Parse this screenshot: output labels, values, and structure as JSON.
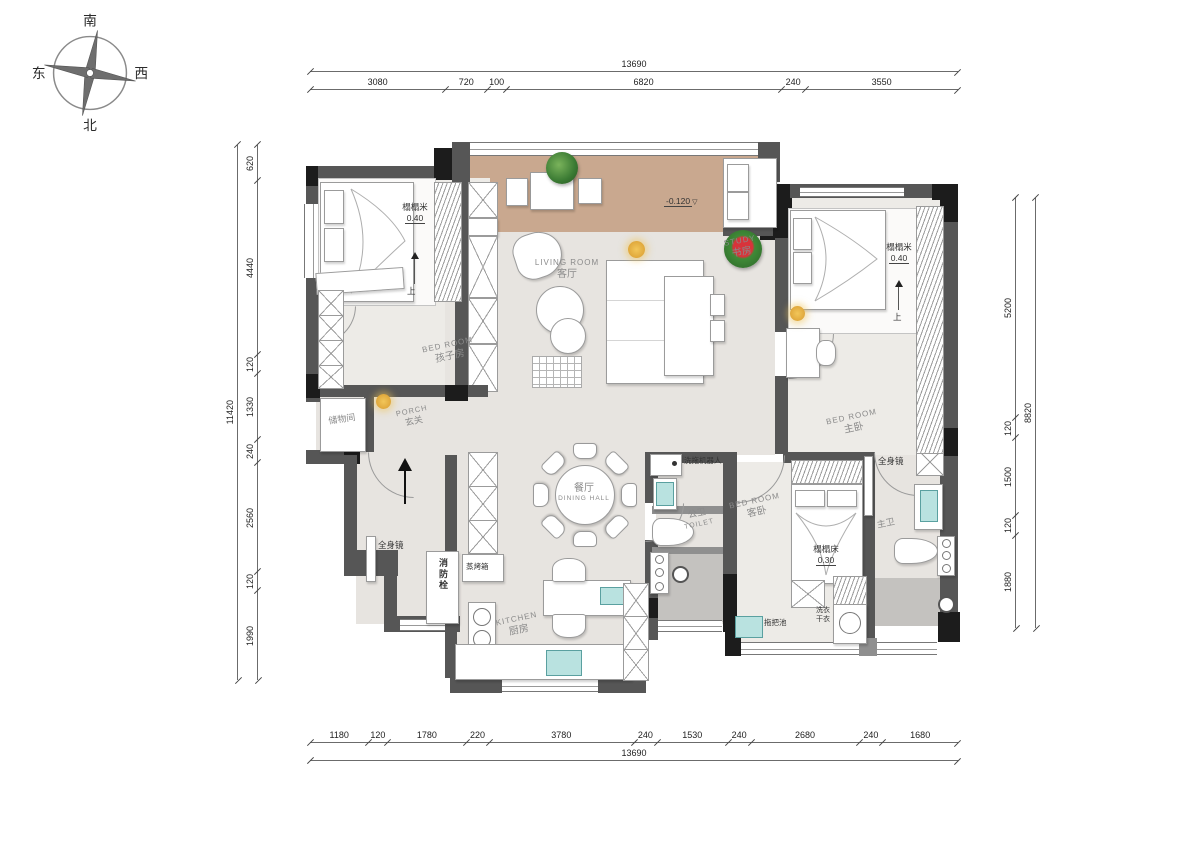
{
  "compass": {
    "south": "南",
    "north": "北",
    "east": "东",
    "west": "西"
  },
  "dimensions": {
    "top_total": "13690",
    "top_segments": [
      "3080",
      "720",
      "100",
      "6820",
      "240",
      "3550"
    ],
    "bottom_segments": [
      "1180",
      "120",
      "1780",
      "220",
      "3780",
      "240",
      "1530",
      "240",
      "2680",
      "240",
      "1680"
    ],
    "bottom_total": "13690",
    "left_total": "11420",
    "left_segments": [
      "620",
      "4440",
      "120",
      "1330",
      "240",
      "2560",
      "120",
      "1990"
    ],
    "right_total": "8820",
    "right_segments": [
      "5200",
      "120",
      "1500",
      "120",
      "1880"
    ]
  },
  "rooms": {
    "children_bedroom": {
      "en": "BED ROOM",
      "cn": "孩子房"
    },
    "living_room": {
      "en": "LIVING ROOM",
      "cn": "客厅"
    },
    "study": {
      "en": "STUDY",
      "cn": "书房"
    },
    "master_bedroom": {
      "en": "BED ROOM",
      "cn": "主卧"
    },
    "guest_bedroom": {
      "en": "BED ROOM",
      "cn": "客卧"
    },
    "dining_hall": {
      "cn": "餐厅",
      "en": "DINING HALL"
    },
    "kitchen": {
      "en": "KITCHEN",
      "cn": "厨房"
    },
    "porch": {
      "en": "PORCH",
      "cn": "玄关"
    },
    "public_toilet": {
      "cn": "公卫",
      "en": "TOILET"
    },
    "master_toilet": {
      "cn": "主卫"
    },
    "storage": {
      "cn": "储物间"
    }
  },
  "annotations": {
    "tatami_children": {
      "label": "榻榻米",
      "height": "0.40"
    },
    "tatami_master": {
      "label": "榻榻米",
      "height": "0.40"
    },
    "tatami_guest": {
      "label": "榻榻床",
      "height": "0.30"
    },
    "up_children": "上",
    "up_master": "上",
    "balcony_level": "-0.120",
    "full_mirror_hall": "全身镜",
    "full_mirror_master": "全身镜",
    "fire_hydrant": "消防栓",
    "steam_oven": "蒸烤箱",
    "wash_robot": "洗拖机器人",
    "mop_sink": "拖把池",
    "washer_line1": "洗衣",
    "washer_line2": "干衣"
  },
  "colors": {
    "wall": "#565656",
    "wall_black": "#1c1c1c",
    "floor": "#e7e4e0",
    "floor_light": "#edebe7",
    "balcony_floor": "#c9a88f",
    "shower_floor": "#c4c2bf",
    "fixture_teal": "#b9e2e0",
    "label_gray": "#8a8a8a"
  }
}
